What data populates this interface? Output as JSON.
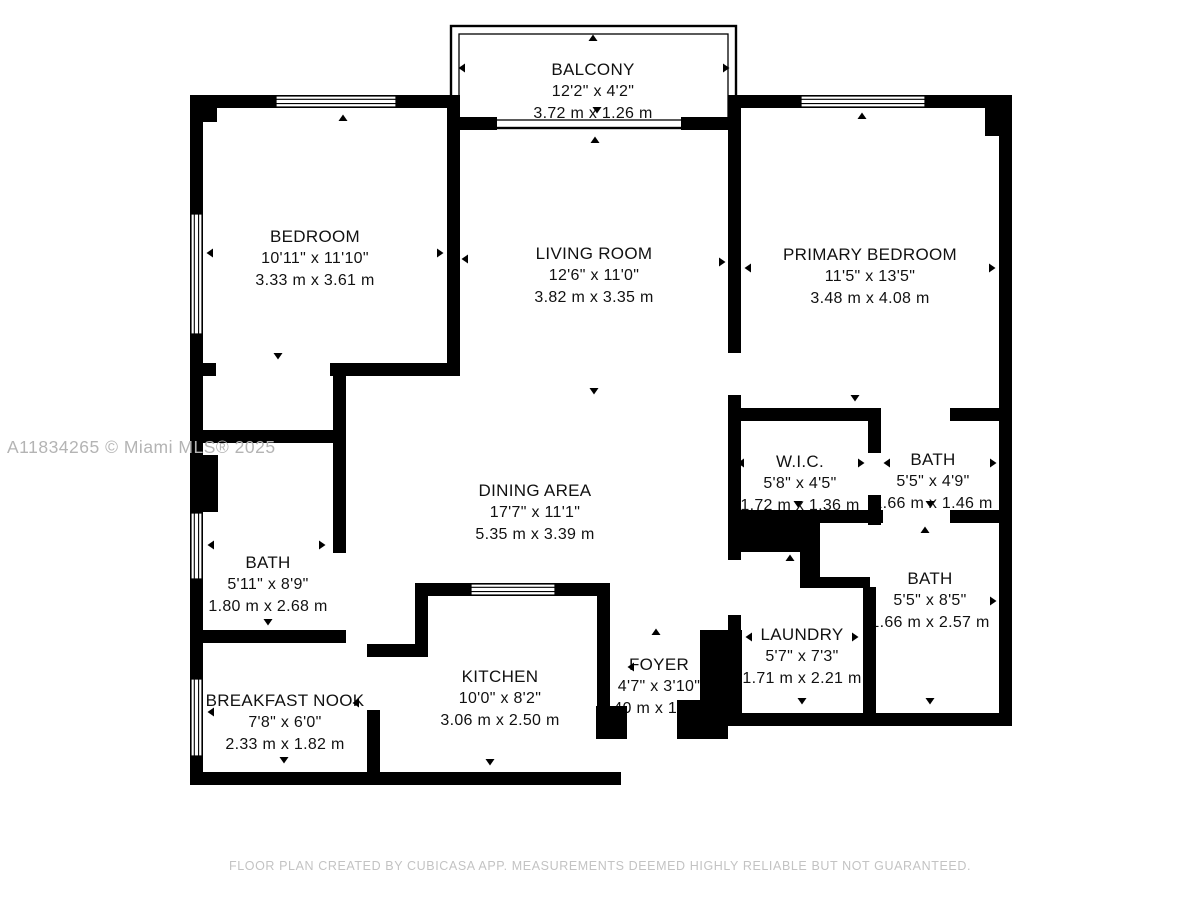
{
  "watermark": "A11834265 © Miami MLS® 2025",
  "footer": "FLOOR PLAN CREATED BY CUBICASA APP. MEASUREMENTS DEEMED HIGHLY RELIABLE BUT NOT GUARANTEED.",
  "colors": {
    "wall": "#000000",
    "background": "#ffffff",
    "label": "#111111",
    "watermark": "#b4b4b4",
    "footer": "#c3c3c3"
  },
  "icons": {
    "measurement-arrow": "small solid black triangle"
  },
  "rooms": [
    {
      "id": "balcony",
      "name": "BALCONY",
      "imperial": "12'2\" x 4'2\"",
      "metric": "3.72 m x 1.26 m"
    },
    {
      "id": "bedroom",
      "name": "BEDROOM",
      "imperial": "10'11\" x 11'10\"",
      "metric": "3.33 m x 3.61 m"
    },
    {
      "id": "living-room",
      "name": "LIVING ROOM",
      "imperial": "12'6\" x 11'0\"",
      "metric": "3.82 m x 3.35 m"
    },
    {
      "id": "primary-bedroom",
      "name": "PRIMARY BEDROOM",
      "imperial": "11'5\" x 13'5\"",
      "metric": "3.48 m x 4.08 m"
    },
    {
      "id": "wic",
      "name": "W.I.C.",
      "imperial": "5'8\" x 4'5\"",
      "metric": "1.72 m x 1.36 m"
    },
    {
      "id": "bath-top",
      "name": "BATH",
      "imperial": "5'5\" x 4'9\"",
      "metric": "1.66 m x 1.46 m"
    },
    {
      "id": "dining-area",
      "name": "DINING AREA",
      "imperial": "17'7\" x 11'1\"",
      "metric": "5.35 m x 3.39 m"
    },
    {
      "id": "bath-left",
      "name": "BATH",
      "imperial": "5'11\" x 8'9\"",
      "metric": "1.80 m x 2.68 m"
    },
    {
      "id": "bath-right",
      "name": "BATH",
      "imperial": "5'5\" x 8'5\"",
      "metric": "1.66 m x 2.57 m"
    },
    {
      "id": "laundry",
      "name": "LAUNDRY",
      "imperial": "5'7\" x 7'3\"",
      "metric": "1.71 m x 2.21 m"
    },
    {
      "id": "breakfast-nook",
      "name": "BREAKFAST NOOK",
      "imperial": "7'8\" x 6'0\"",
      "metric": "2.33 m x 1.82 m"
    },
    {
      "id": "kitchen",
      "name": "KITCHEN",
      "imperial": "10'0\" x 8'2\"",
      "metric": "3.06 m x 2.50 m"
    },
    {
      "id": "foyer",
      "name": "FOYER",
      "imperial": "4'7\" x 3'10\"",
      "metric": "1.40 m x 1.16 m"
    }
  ],
  "markers": [
    {
      "x": 593,
      "y": 38,
      "d": "u"
    },
    {
      "x": 462,
      "y": 68,
      "d": "l"
    },
    {
      "x": 726,
      "y": 68,
      "d": "r"
    },
    {
      "x": 597,
      "y": 110,
      "d": "d"
    },
    {
      "x": 595,
      "y": 140,
      "d": "u"
    },
    {
      "x": 343,
      "y": 118,
      "d": "u"
    },
    {
      "x": 210,
      "y": 253,
      "d": "l"
    },
    {
      "x": 440,
      "y": 253,
      "d": "r"
    },
    {
      "x": 278,
      "y": 356,
      "d": "d"
    },
    {
      "x": 862,
      "y": 116,
      "d": "u"
    },
    {
      "x": 465,
      "y": 259,
      "d": "l"
    },
    {
      "x": 722,
      "y": 262,
      "d": "r"
    },
    {
      "x": 594,
      "y": 391,
      "d": "d"
    },
    {
      "x": 748,
      "y": 268,
      "d": "l"
    },
    {
      "x": 992,
      "y": 268,
      "d": "r"
    },
    {
      "x": 855,
      "y": 398,
      "d": "d"
    },
    {
      "x": 795,
      "y": 416,
      "d": "u"
    },
    {
      "x": 741,
      "y": 463,
      "d": "l"
    },
    {
      "x": 861,
      "y": 463,
      "d": "r"
    },
    {
      "x": 798,
      "y": 504,
      "d": "d"
    },
    {
      "x": 887,
      "y": 463,
      "d": "l"
    },
    {
      "x": 993,
      "y": 463,
      "d": "r"
    },
    {
      "x": 930,
      "y": 504,
      "d": "d"
    },
    {
      "x": 268,
      "y": 437,
      "d": "u"
    },
    {
      "x": 211,
      "y": 545,
      "d": "l"
    },
    {
      "x": 322,
      "y": 545,
      "d": "r"
    },
    {
      "x": 268,
      "y": 622,
      "d": "d"
    },
    {
      "x": 925,
      "y": 530,
      "d": "u"
    },
    {
      "x": 993,
      "y": 601,
      "d": "r"
    },
    {
      "x": 930,
      "y": 701,
      "d": "d"
    },
    {
      "x": 790,
      "y": 558,
      "d": "u"
    },
    {
      "x": 749,
      "y": 637,
      "d": "l"
    },
    {
      "x": 855,
      "y": 637,
      "d": "r"
    },
    {
      "x": 802,
      "y": 701,
      "d": "d"
    },
    {
      "x": 604,
      "y": 607,
      "d": "u"
    },
    {
      "x": 490,
      "y": 762,
      "d": "d"
    },
    {
      "x": 211,
      "y": 712,
      "d": "l"
    },
    {
      "x": 356,
      "y": 703,
      "d": "l"
    },
    {
      "x": 284,
      "y": 760,
      "d": "d"
    },
    {
      "x": 631,
      "y": 667,
      "d": "l"
    },
    {
      "x": 718,
      "y": 667,
      "d": "r"
    },
    {
      "x": 600,
      "y": 710,
      "d": "r"
    },
    {
      "x": 656,
      "y": 632,
      "d": "u"
    }
  ]
}
